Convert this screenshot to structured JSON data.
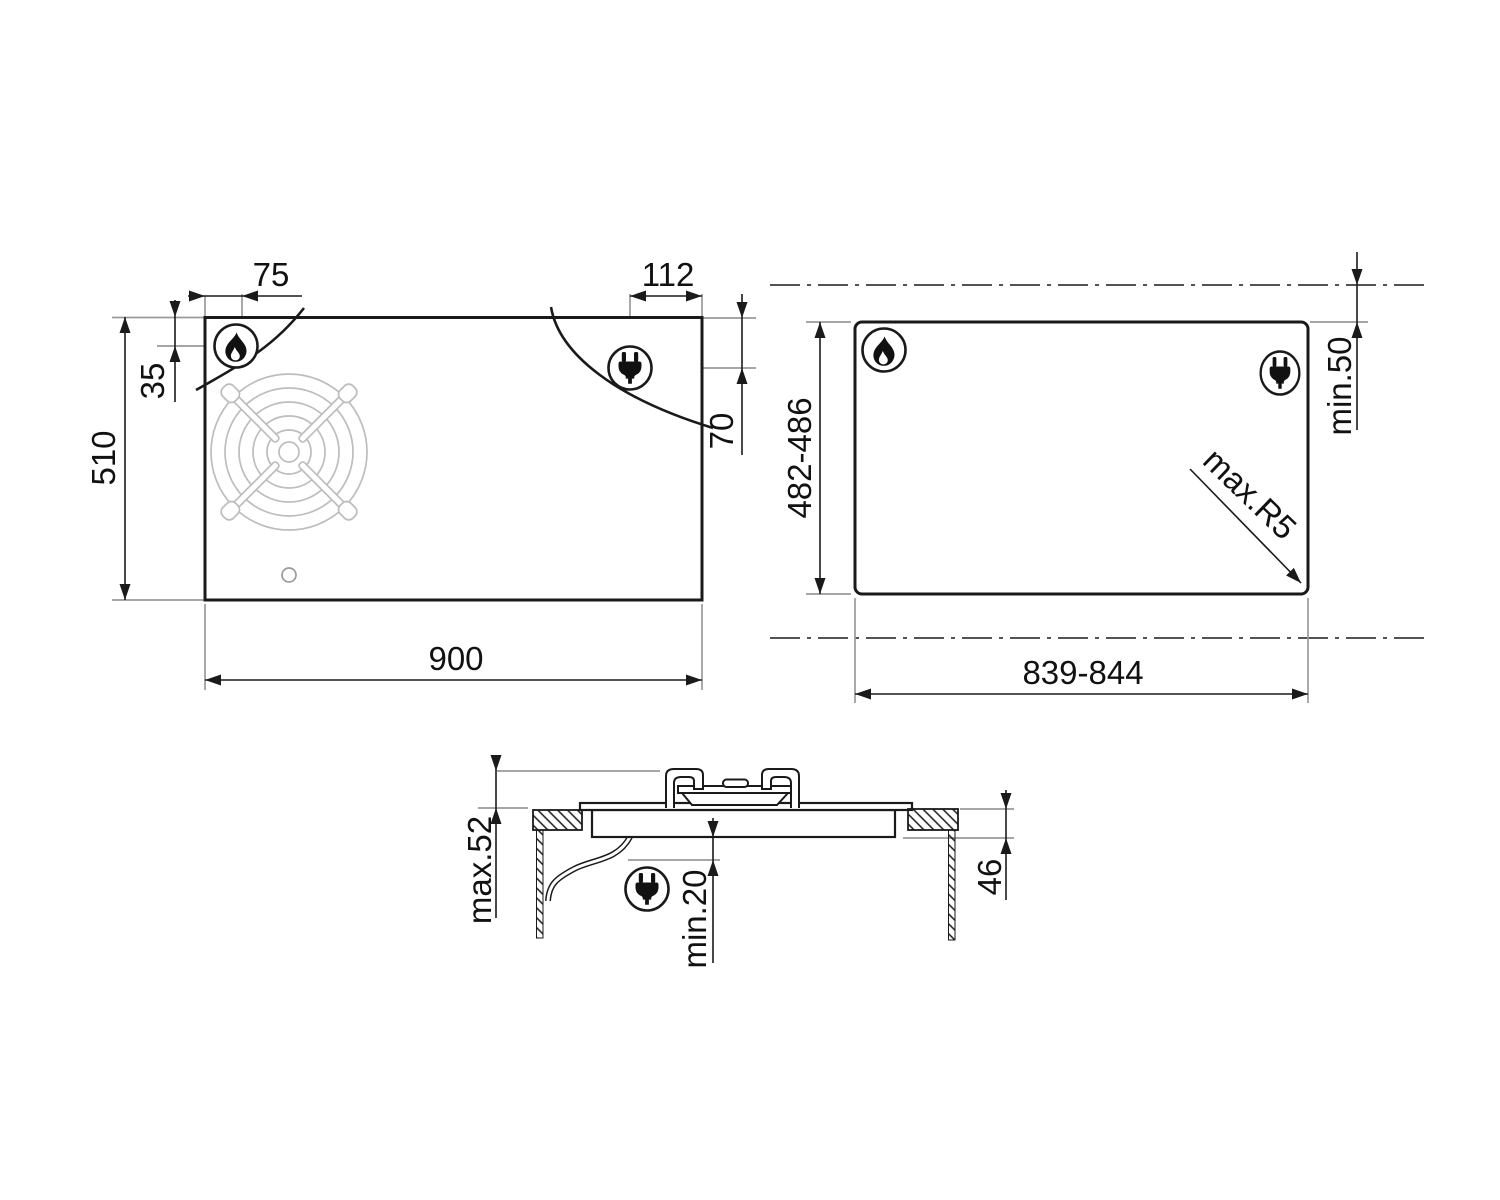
{
  "drawing": {
    "kind": "hob-installation-dimension-drawing",
    "colors": {
      "line": "#1a1a1a",
      "reference": "#9a9a9a",
      "grate": "#bdbdbd",
      "background": "#ffffff"
    },
    "icons": {
      "gas": "flame-icon",
      "electrical": "plug-icon"
    }
  },
  "labels": {
    "plan_burner_offset_x": "75",
    "plan_socket_offset_x": "112",
    "plan_burner_offset_y": "35",
    "plan_height": "510",
    "plan_socket_offset_y": "70",
    "plan_width": "900",
    "cutout_height": "482-486",
    "cutout_width": "839-844",
    "cutout_rear_clearance": "min.50",
    "cutout_corner_radius": "max.R5",
    "section_height_above": "max.52",
    "section_clearance_below": "min.20",
    "section_depth_below": "46"
  }
}
